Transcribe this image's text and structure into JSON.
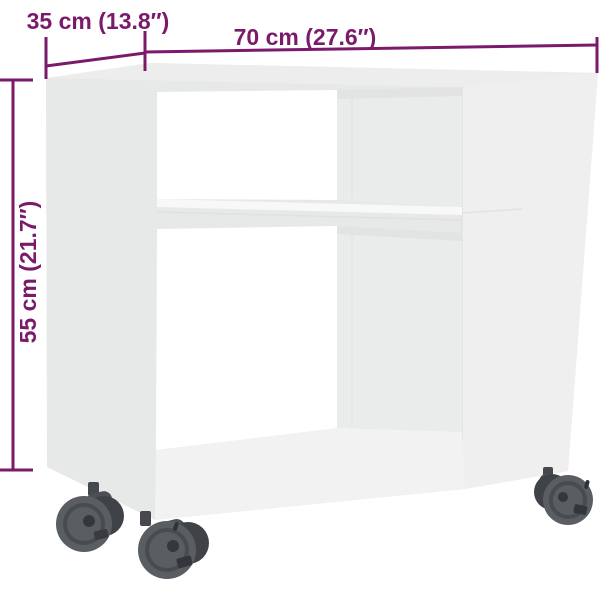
{
  "diagram": {
    "type": "product-dimension-diagram",
    "product": "side table with wheels",
    "dimensions": {
      "width": {
        "label": "70 cm (27.6″)"
      },
      "depth": {
        "label": "35 cm (13.8″)"
      },
      "height": {
        "label": "55 cm (21.7″)"
      }
    }
  },
  "colors": {
    "accent": "#7b1a6b",
    "background": "#ffffff",
    "furniture_face": "#e7e8e8",
    "furniture_top": "#ededee",
    "furniture_right_panel": "#efeff0",
    "furniture_interior": "#eaebeb",
    "opening": "#ffffff",
    "caster_body": "#54585c",
    "caster_dark": "#3e4246"
  }
}
